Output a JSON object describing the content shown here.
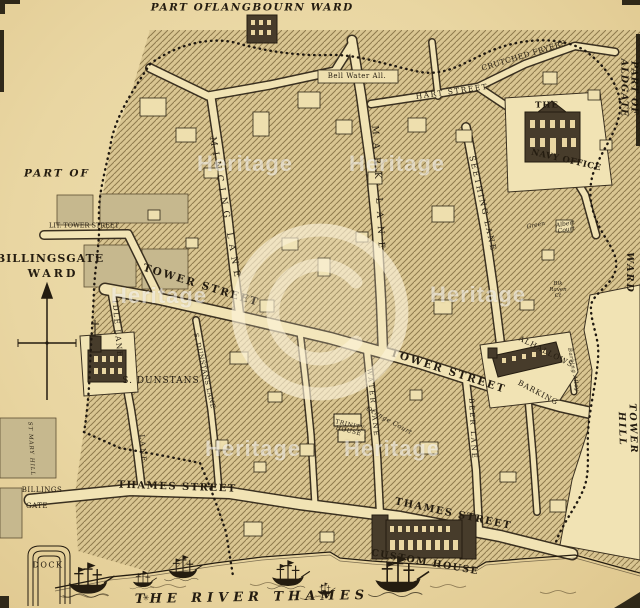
{
  "page": {
    "width": 640,
    "height": 608
  },
  "colors": {
    "paper": "#e9d6a2",
    "street": "#f1e3b4",
    "ink": "#241c10",
    "hatch_fill": "#d9c591",
    "hatch_line": "#8f7b4e",
    "building_dark": "#473c2b",
    "gray_block": "#c6b88e",
    "watermark": "rgba(255,255,255,0.55)"
  },
  "labels": [
    {
      "name": "label-part-of-langbourn",
      "text": "PART OF",
      "x": 182,
      "y": 8,
      "r": 0,
      "s": 10.5,
      "ls": 1.5,
      "it": 1,
      "b": 1
    },
    {
      "name": "label-langbourn-ward",
      "text": "LANGBOURN WARD",
      "x": 283,
      "y": 8,
      "r": 0,
      "s": 10.5,
      "ls": 1.5,
      "it": 1,
      "b": 1
    },
    {
      "name": "label-part-of-aldgate",
      "text": "PART OF ALDGATE",
      "x": 628,
      "y": 88,
      "r": 90,
      "s": 9.5,
      "ls": 1,
      "it": 1,
      "b": 1
    },
    {
      "name": "label-aldgate-ward",
      "text": "WARD",
      "x": 629,
      "y": 273,
      "r": 90,
      "s": 9.5,
      "ls": 2,
      "it": 1,
      "b": 1
    },
    {
      "name": "label-great-tower-hill",
      "text": "GREAT TOWER HILL",
      "x": 632,
      "y": 429,
      "r": 88,
      "s": 9.5,
      "ls": 2,
      "it": 1,
      "b": 1
    },
    {
      "name": "label-part-of-billingsgate",
      "text": "PART OF",
      "x": 57,
      "y": 174,
      "r": 0,
      "s": 10.5,
      "ls": 2,
      "it": 1,
      "b": 1
    },
    {
      "name": "label-billingsgate",
      "text": "BILLINGSGATE",
      "x": 50,
      "y": 259,
      "r": 0,
      "s": 11,
      "ls": 1,
      "it": 0,
      "b": 1
    },
    {
      "name": "label-billingsgate-ward",
      "text": "WARD",
      "x": 53,
      "y": 274,
      "r": 0,
      "s": 11,
      "ls": 3,
      "it": 0,
      "b": 1
    },
    {
      "name": "label-lit-tower-street",
      "text": "LIT. TOWER STREET",
      "x": 84,
      "y": 226,
      "r": 0,
      "s": 6.5,
      "ls": 0,
      "it": 0,
      "b": 0
    },
    {
      "name": "label-tower-street-1",
      "text": "TOWER STREET",
      "x": 201,
      "y": 286,
      "r": 17,
      "s": 10.5,
      "ls": 2,
      "it": 0,
      "b": 1
    },
    {
      "name": "label-tower-street-2",
      "text": "TOWER STREET",
      "x": 448,
      "y": 372,
      "r": 18,
      "s": 10.5,
      "ls": 2,
      "it": 0,
      "b": 1
    },
    {
      "name": "label-thames-street-1",
      "text": "THAMES STREET",
      "x": 177,
      "y": 488,
      "r": 2,
      "s": 10,
      "ls": 1.5,
      "it": 0,
      "b": 1
    },
    {
      "name": "label-thames-street-2",
      "text": "THAMES STREET",
      "x": 453,
      "y": 515,
      "r": 12,
      "s": 10,
      "ls": 1.5,
      "it": 0,
      "b": 1
    },
    {
      "name": "label-river-ornament",
      "text": "✳",
      "x": 146,
      "y": 599,
      "r": 0,
      "s": 8,
      "ls": 0,
      "it": 0,
      "b": 0
    },
    {
      "name": "label-the-river-thames",
      "text": "THE RIVER THAMES",
      "x": 252,
      "y": 598,
      "r": -1,
      "s": 13,
      "ls": 5,
      "it": 1,
      "b": 1
    },
    {
      "name": "label-custom-house",
      "text": "CUSTOM HOUSE",
      "x": 425,
      "y": 563,
      "r": 10,
      "s": 9.5,
      "ls": 1.5,
      "it": 0,
      "b": 1
    },
    {
      "name": "label-the-navy",
      "text": "THE",
      "x": 547,
      "y": 106,
      "r": 0,
      "s": 8.5,
      "ls": 1,
      "it": 0,
      "b": 1
    },
    {
      "name": "label-navy-office",
      "text": "NAVY OFFICE",
      "x": 566,
      "y": 161,
      "r": 13,
      "s": 8.5,
      "ls": 0.5,
      "it": 0,
      "b": 1
    },
    {
      "name": "label-hart-street",
      "text": "HART STREET",
      "x": 452,
      "y": 92,
      "r": -8,
      "s": 7.5,
      "ls": 1.5,
      "it": 0,
      "b": 0
    },
    {
      "name": "label-crutched-fryers",
      "text": "CRUTCHED FRYERS",
      "x": 524,
      "y": 56,
      "r": -17,
      "s": 7.5,
      "ls": 0.5,
      "it": 0,
      "b": 0
    },
    {
      "name": "label-mincing-lane",
      "text": "MINCING LANE",
      "x": 224,
      "y": 210,
      "r": 80,
      "s": 9,
      "ls": 6,
      "it": 0,
      "b": 0
    },
    {
      "name": "label-mark-lane",
      "text": "MARK LANE",
      "x": 377,
      "y": 191,
      "r": 87,
      "s": 9,
      "ls": 8,
      "it": 0,
      "b": 0
    },
    {
      "name": "label-seething-lane",
      "text": "SEETHING LANE",
      "x": 482,
      "y": 204,
      "r": 77,
      "s": 8,
      "ls": 2,
      "it": 0,
      "b": 0
    },
    {
      "name": "label-idle-lane",
      "text": "IDLE LANE",
      "x": 117,
      "y": 329,
      "r": 85,
      "s": 7.5,
      "ls": 1.5,
      "it": 0,
      "b": 0
    },
    {
      "name": "label-lane",
      "text": "LANE",
      "x": 142,
      "y": 449,
      "r": 86,
      "s": 7,
      "ls": 2,
      "it": 0,
      "b": 0
    },
    {
      "name": "label-st-mary-hill",
      "text": "ST MARY HILL",
      "x": 30,
      "y": 449,
      "r": 87,
      "s": 5.5,
      "ls": 1,
      "it": 1,
      "b": 0
    },
    {
      "name": "label-s-dunstans-lane",
      "text": "S. DUNSTANS LANE",
      "x": 204,
      "y": 371,
      "r": 77,
      "s": 6.5,
      "ls": 0.5,
      "it": 0,
      "b": 0
    },
    {
      "name": "label-s-dunstans",
      "text": "S. DUNSTANS",
      "x": 161,
      "y": 382,
      "r": 0,
      "s": 9,
      "ls": 1,
      "it": 0,
      "b": 0
    },
    {
      "name": "label-water-lane",
      "text": "WATER LANE",
      "x": 372,
      "y": 403,
      "r": 84,
      "s": 7,
      "ls": 2,
      "it": 0,
      "b": 0
    },
    {
      "name": "label-beer-lane",
      "text": "BEER LANE",
      "x": 472,
      "y": 429,
      "r": 87,
      "s": 7,
      "ls": 2,
      "it": 0,
      "b": 0
    },
    {
      "name": "label-trinity-house",
      "text": "TRINITY\nHOUSE",
      "x": 349,
      "y": 429,
      "r": 14,
      "s": 6,
      "ls": 0.5,
      "it": 0,
      "b": 0
    },
    {
      "name": "label-orange-court",
      "text": "Orange Court",
      "x": 389,
      "y": 421,
      "r": 29,
      "s": 6.5,
      "ls": 0.5,
      "it": 1,
      "b": 0
    },
    {
      "name": "label-green",
      "text": "Green",
      "x": 536,
      "y": 226,
      "r": -12,
      "s": 6,
      "ls": 0,
      "it": 1,
      "b": 0
    },
    {
      "name": "label-albert-court",
      "text": "Albert\nCourt",
      "x": 566,
      "y": 228,
      "r": -10,
      "s": 6,
      "ls": 0,
      "it": 1,
      "b": 0
    },
    {
      "name": "label-blk-raven-ct",
      "text": "Blk\nRaven\nCt",
      "x": 558,
      "y": 291,
      "r": 0,
      "s": 5.5,
      "ls": 0,
      "it": 1,
      "b": 0
    },
    {
      "name": "label-alhallows",
      "text": "ALHALLOWS",
      "x": 546,
      "y": 352,
      "r": 27,
      "s": 7.5,
      "ls": 1,
      "it": 0,
      "b": 0
    },
    {
      "name": "label-barking",
      "text": "BARKING",
      "x": 538,
      "y": 393,
      "r": 28,
      "s": 7.5,
      "ls": 1,
      "it": 0,
      "b": 0
    },
    {
      "name": "label-barking-alley",
      "text": "Barking Alley",
      "x": 572,
      "y": 370,
      "r": 80,
      "s": 5.5,
      "ls": 0.5,
      "it": 1,
      "b": 0
    },
    {
      "name": "label-billings",
      "text": "BILLINGS",
      "x": 42,
      "y": 491,
      "r": 0,
      "s": 7,
      "ls": 0.5,
      "it": 0,
      "b": 0
    },
    {
      "name": "label-gate",
      "text": "GATE",
      "x": 37,
      "y": 507,
      "r": 0,
      "s": 7,
      "ls": 0.5,
      "it": 0,
      "b": 0
    },
    {
      "name": "label-dock",
      "text": "DOCK",
      "x": 48,
      "y": 566,
      "r": 0,
      "s": 8,
      "ls": 1.5,
      "it": 0,
      "b": 0
    },
    {
      "name": "label-bell-water",
      "text": "Bell Water All.",
      "x": 357,
      "y": 77,
      "r": 0,
      "s": 7,
      "ls": 0.5,
      "it": 0,
      "b": 0
    }
  ],
  "watermark": {
    "text": "Heritage",
    "symbol": "©",
    "positions": [
      {
        "x": 159,
        "y": 296
      },
      {
        "x": 478,
        "y": 295
      },
      {
        "x": 245,
        "y": 164
      },
      {
        "x": 397,
        "y": 164
      },
      {
        "x": 253,
        "y": 449
      },
      {
        "x": 392,
        "y": 449
      }
    ]
  }
}
